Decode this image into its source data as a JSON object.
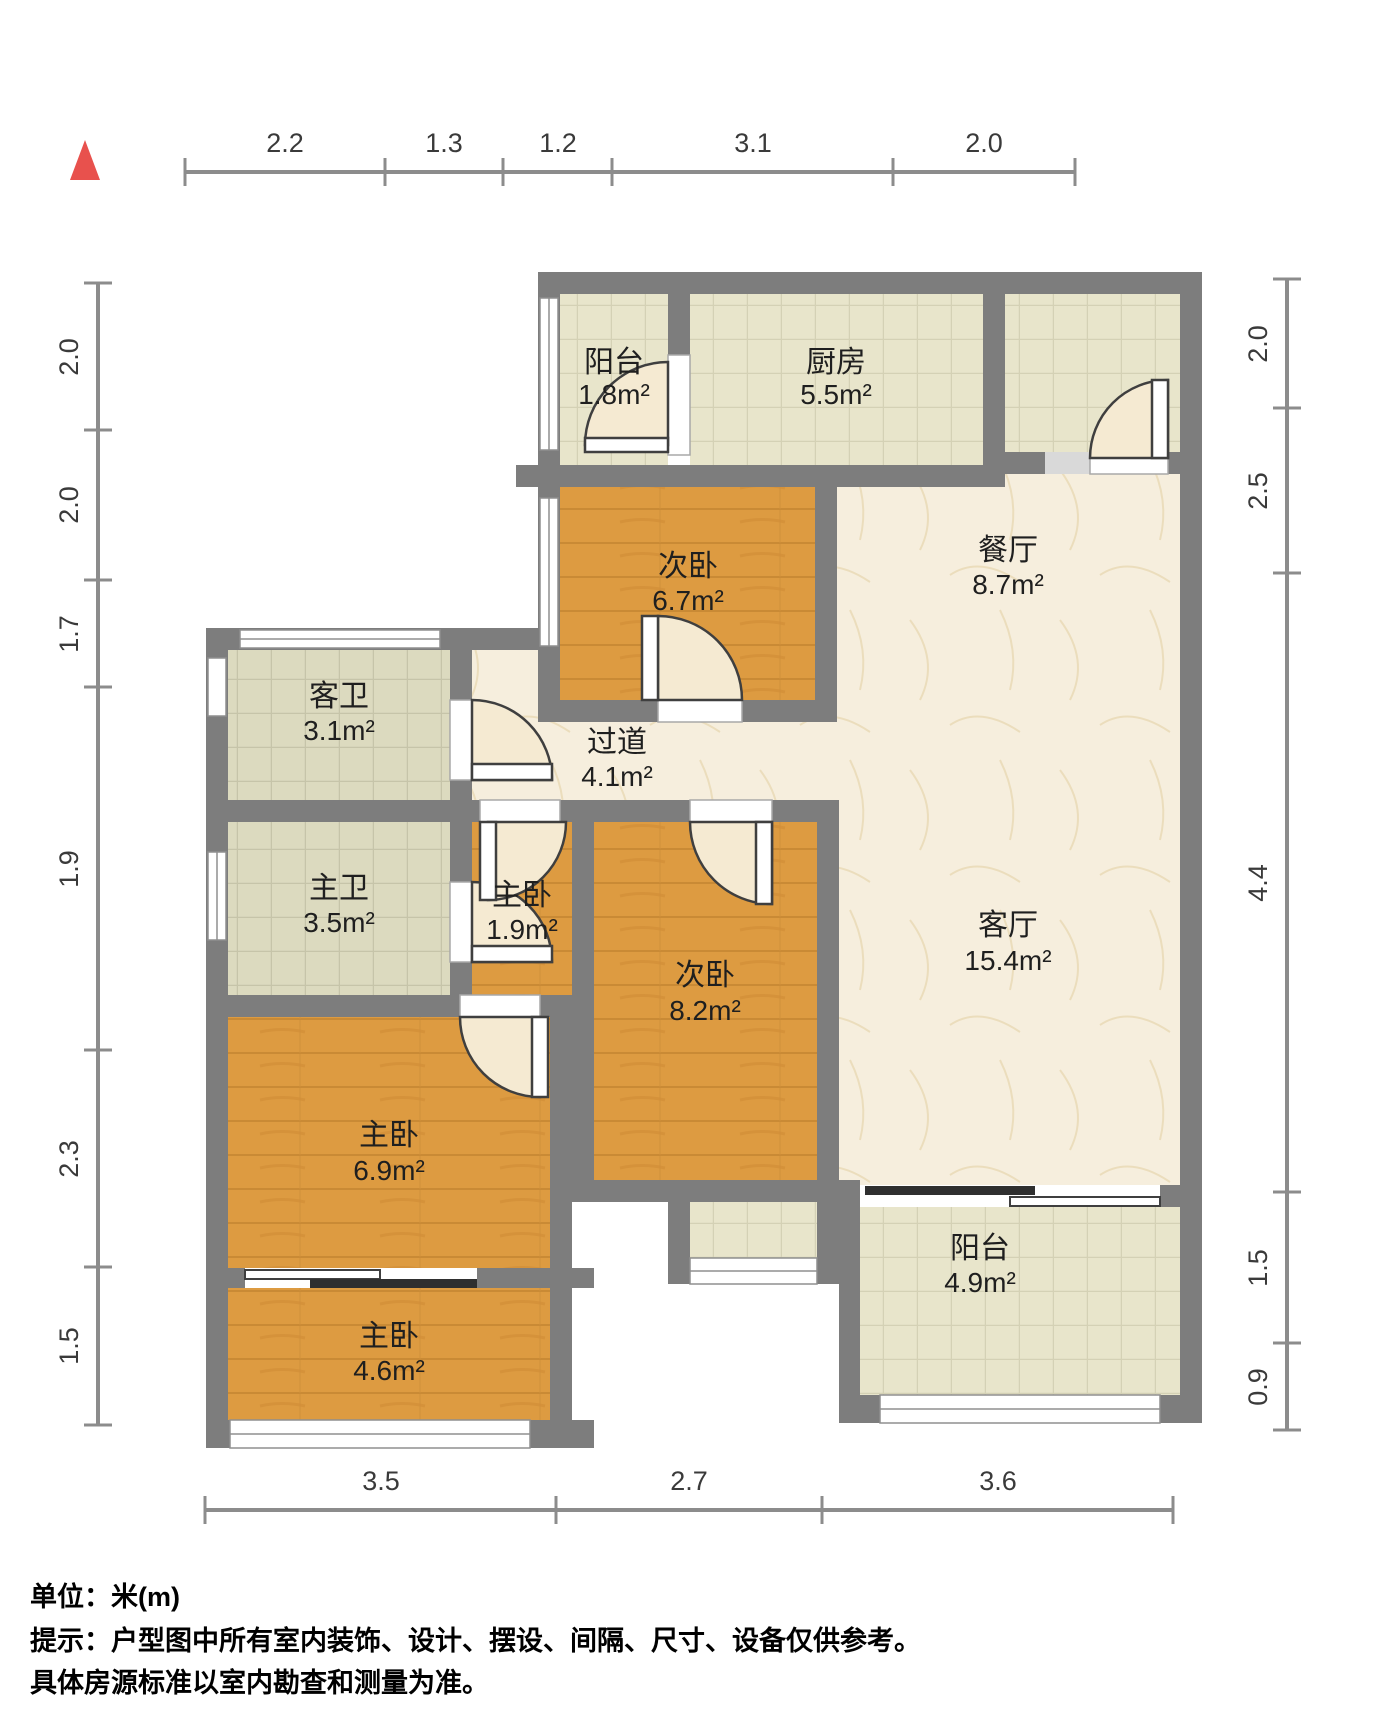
{
  "plan": {
    "unit_label": "单位：米(m)",
    "tip_line1": "提示：户型图中所有室内装饰、设计、摆设、间隔、尺寸、设备仅供参考。",
    "tip_line2": "具体房源标准以室内勘查和测量为准。"
  },
  "rooms": {
    "balcony_top": {
      "name": "阳台",
      "area": "1.8m²"
    },
    "kitchen": {
      "name": "厨房",
      "area": "5.5m²"
    },
    "bedroom_second_upper": {
      "name": "次卧",
      "area": "6.7m²"
    },
    "dining": {
      "name": "餐厅",
      "area": "8.7m²"
    },
    "bath_guest": {
      "name": "客卫",
      "area": "3.1m²"
    },
    "hallway": {
      "name": "过道",
      "area": "4.1m²"
    },
    "bath_master": {
      "name": "主卫",
      "area": "3.5m²"
    },
    "bedroom_master_small": {
      "name": "主卧",
      "area": "1.9m²"
    },
    "bedroom_second_lower": {
      "name": "次卧",
      "area": "8.2m²"
    },
    "living": {
      "name": "客厅",
      "area": "15.4m²"
    },
    "bedroom_master_mid": {
      "name": "主卧",
      "area": "6.9m²"
    },
    "balcony_bottom": {
      "name": "阳台",
      "area": "4.9m²"
    },
    "bedroom_master_bottom": {
      "name": "主卧",
      "area": "4.6m²"
    }
  },
  "dimensions": {
    "top": [
      "2.2",
      "1.3",
      "1.2",
      "3.1",
      "2.0"
    ],
    "bottom": [
      "3.5",
      "2.7",
      "3.6"
    ],
    "left": [
      "2.0",
      "2.0",
      "1.7",
      "1.9",
      "2.3",
      "1.5"
    ],
    "right": [
      "2.0",
      "2.5",
      "4.4",
      "1.5",
      "0.9"
    ]
  },
  "colors": {
    "wall": "#7d7d7d",
    "wood_floor": "#dd9b41",
    "tile_floor": "#e8e5cb",
    "bath_tile_floor": "#dcdabf",
    "marble_floor": "#f6eedd",
    "north_arrow": "#e8514d"
  }
}
